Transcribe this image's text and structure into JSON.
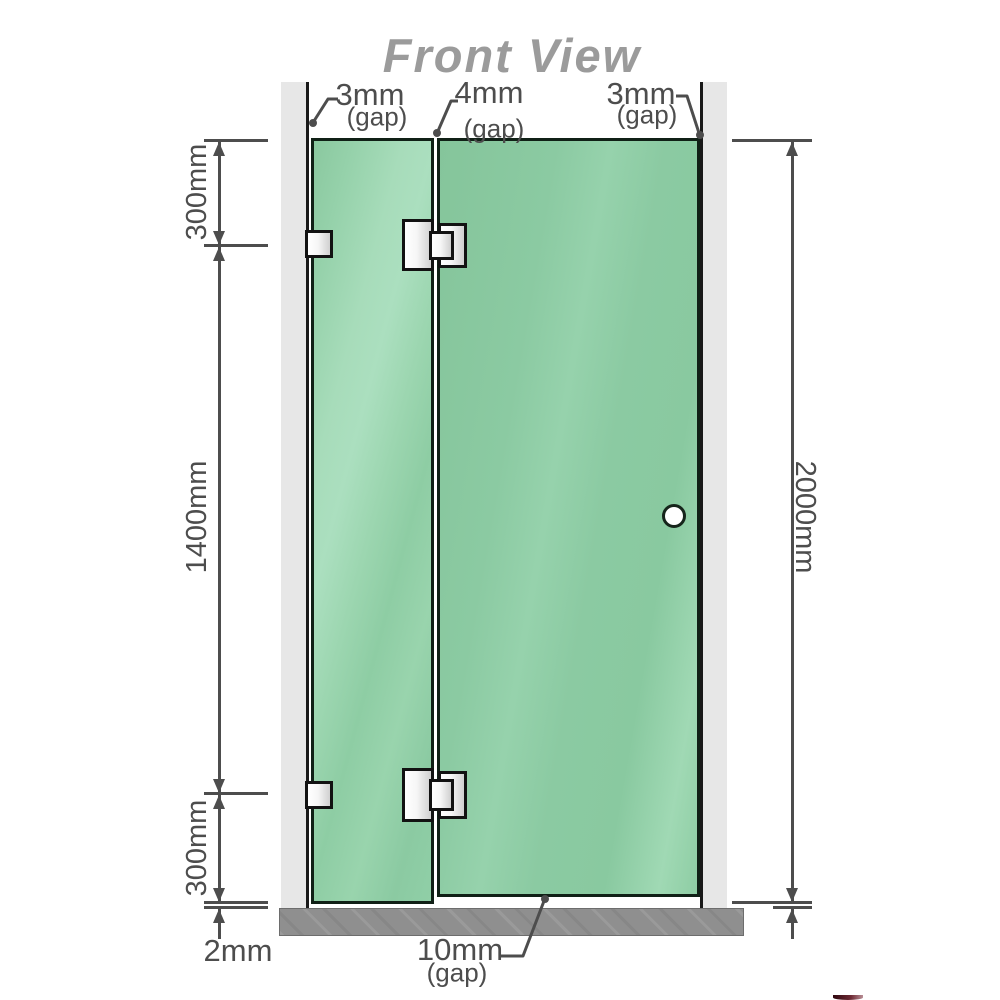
{
  "title": "Front View",
  "colors": {
    "glass": "#8BCAA3",
    "glass_highlight": "#ABDFBF",
    "wall": "#E7E7E7",
    "base": "#8F8F8F",
    "outline": "#121212",
    "dimension": "#4D4D4D",
    "title_text": "#9B9B9B",
    "hardware": "#FFFFFF"
  },
  "gaps": {
    "left": {
      "value": "3mm",
      "label": "(gap)"
    },
    "middle": {
      "value": "4mm",
      "label": "(gap)"
    },
    "right": {
      "value": "3mm",
      "label": "(gap)"
    },
    "bottom": {
      "value": "10mm",
      "label": "(gap)"
    }
  },
  "dimensions": {
    "top_segment": "300mm",
    "middle_segment": "1400mm",
    "bottom_segment": "300mm",
    "base_gap": "2mm",
    "total_height": "2000mm"
  }
}
